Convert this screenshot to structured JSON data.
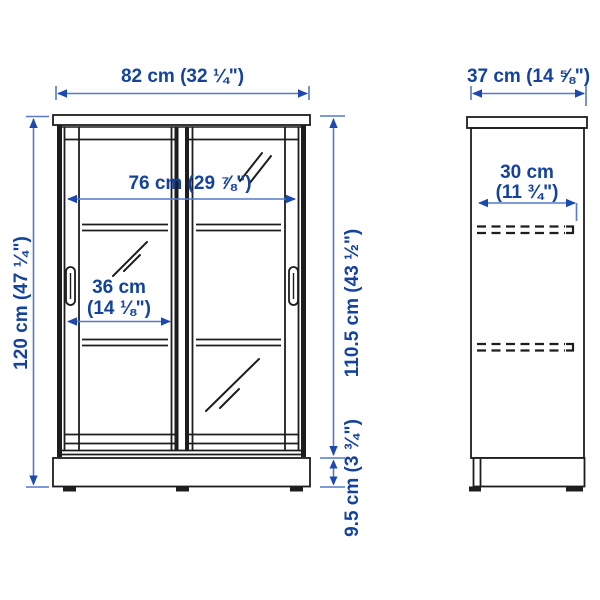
{
  "diagram": {
    "type": "product-dimension-diagram",
    "product": "cabinet with sliding glass doors",
    "views": [
      "front",
      "side"
    ]
  },
  "front_view": {
    "width": "82 cm (32 ¼\")",
    "height": "120 cm (47 ¼\")",
    "inner_width": "76 cm (29 ⅞\")",
    "door_width_metric": "36 cm",
    "door_width_imperial": "(14 ⅛\")",
    "door_height": "110.5 cm (43 ½\")",
    "plinth_height": "9.5 cm (3 ¾\")"
  },
  "side_view": {
    "depth": "37 cm (14 ⅝\")",
    "inner_depth_metric": "30 cm",
    "inner_depth_imperial": "(11 ¾\")"
  },
  "colors": {
    "dimension_text": "#15439c",
    "dimension_line": "#5578cc",
    "arrowhead": "#1d48ad",
    "drawing_line": "#1d1d1f",
    "background": "#ffffff"
  }
}
